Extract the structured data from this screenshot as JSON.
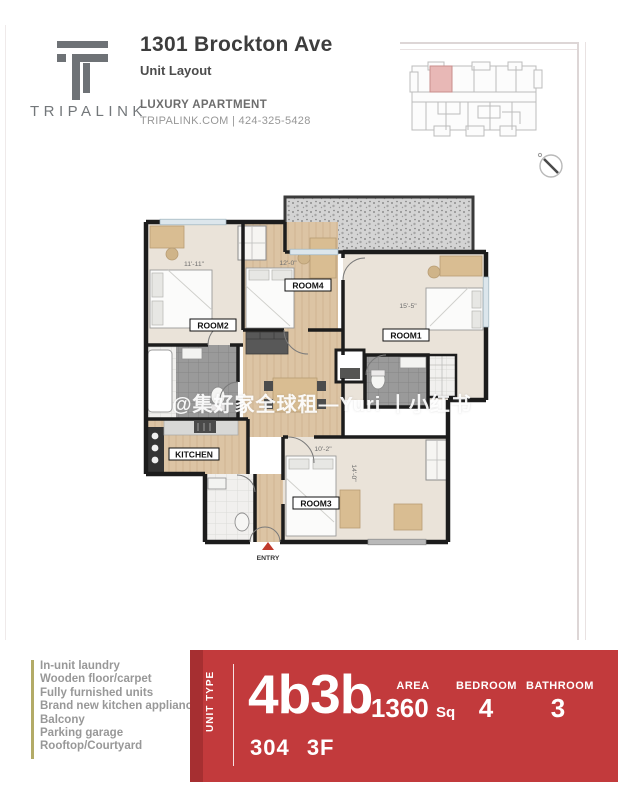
{
  "brand": {
    "logo_text": "TRIPALINK"
  },
  "header": {
    "address": "1301 Brockton Ave",
    "subtitle": "Unit Layout",
    "tagline": "LUXURY APARTMENT",
    "contact": "TRIPALINK.COM | 424-325-5428"
  },
  "plan": {
    "rooms": {
      "room1": "ROOM1",
      "room2": "ROOM2",
      "room3": "ROOM3",
      "room4": "ROOM4",
      "kitchen": "KITCHEN",
      "laundry": "LNDRY",
      "entry": "ENTRY"
    },
    "dims": {
      "room2": "11'-11\"",
      "room4": "12'-0\"",
      "room1": "15'-5\"",
      "room3_width": "10'-2\"",
      "room3_depth": "14'-0\""
    },
    "watermark": "@集好家全球租—Yuri 丨小红书"
  },
  "amenities": [
    "In-unit laundry",
    "Wooden floor/carpet",
    "Fully furnished units",
    "Brand new kitchen appliances",
    "Balcony",
    "Parking garage",
    "Rooftop/Courtyard"
  ],
  "unit_info": {
    "unit_type_label": "UNIT TYPE",
    "unit_type": "4b3b",
    "area_label": "AREA",
    "area_value": "1360",
    "area_unit": "Sq",
    "bedroom_label": "BEDROOM",
    "bedroom_value": "4",
    "bathroom_label": "BATHROOM",
    "bathroom_value": "3",
    "unit_number": "304 3F"
  },
  "colors": {
    "banner_red": "#c23a3c",
    "banner_red_dark": "#a62f31",
    "entry_marker_red": "#c0392b",
    "logo_gray": "#6e7276",
    "amenity_bar_olive": "#b3ab67",
    "highlight_unit_pink": "#e8b8b6"
  }
}
